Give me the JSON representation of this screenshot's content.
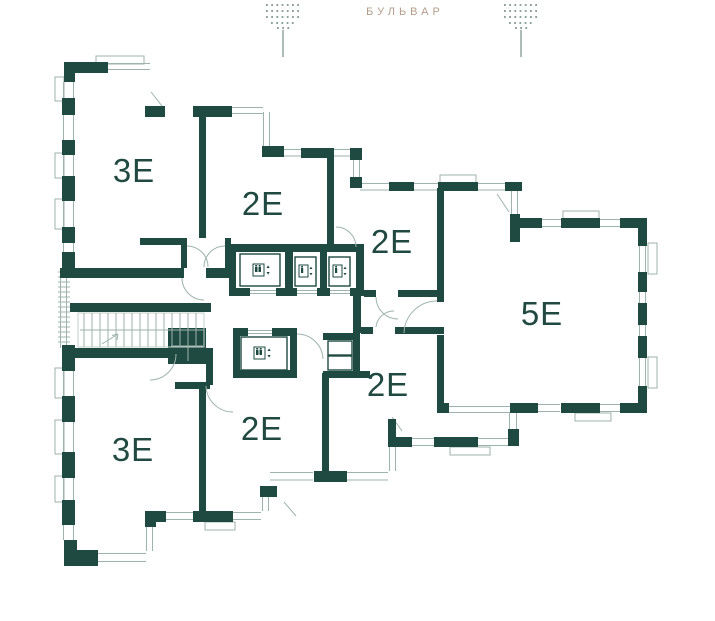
{
  "street": {
    "label": "БУЛЬВАР"
  },
  "apartments": [
    {
      "label": "3Е",
      "position": "top-left"
    },
    {
      "label": "2Е",
      "position": "upper-middle"
    },
    {
      "label": "2Е",
      "position": "middle-right-of-core"
    },
    {
      "label": "5Е",
      "position": "right"
    },
    {
      "label": "2Е",
      "position": "lower-middle-right"
    },
    {
      "label": "2Е",
      "position": "lower-middle"
    },
    {
      "label": "3Е",
      "position": "bottom-left"
    }
  ],
  "core": {
    "passenger_elevators": 3,
    "cargo_elevators": 1,
    "staircase": true
  },
  "icons": {
    "elevator": "elevator-icon",
    "tree": "tree-icon",
    "staircase": "staircase",
    "door_swing": "door-arc"
  },
  "colors": {
    "wall": "#1e4a41",
    "thin": "#9db3ac",
    "thin2": "#c2d0ca",
    "accent": "#b49c8c",
    "label": "#204a41"
  }
}
